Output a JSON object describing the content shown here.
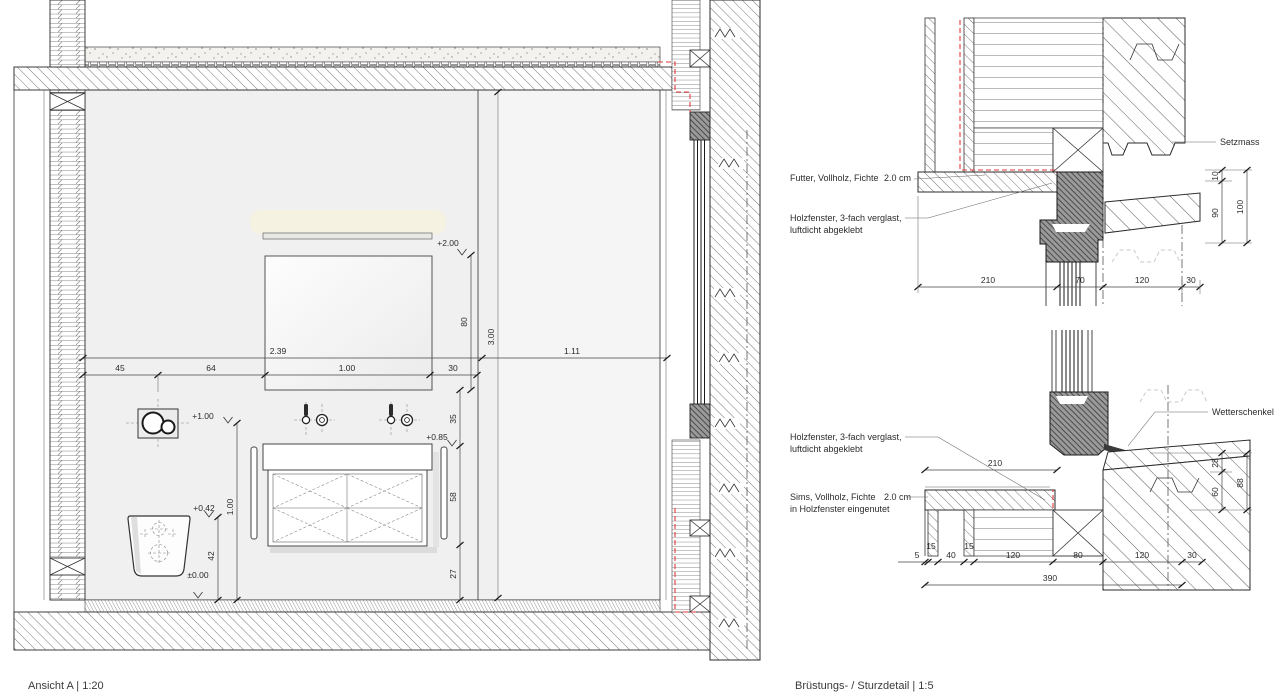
{
  "colors": {
    "airtight_tape_red": "#e03a3a",
    "room_fill": "#f0f0f0",
    "frame_gray": "#9a9a9a"
  },
  "elevation": {
    "caption": "Ansicht A | 1:20",
    "dim_239": "2.39",
    "dim_111": "1.11",
    "chain_bottom": [
      "45",
      "64",
      "1.00",
      "30"
    ],
    "dim_300": "3.00",
    "dim_80": "80",
    "chain_right": [
      "35",
      "58",
      "27"
    ],
    "dim_100": "1.00",
    "dim_42": "42",
    "lvl_200": "+2.00",
    "lvl_100": "+1.00",
    "lvl_085": "+0.85",
    "lvl_042": "+0.42",
    "lvl_000": "±0.00"
  },
  "lintel": {
    "label_futter": "Futter, Vollholz, Fichte",
    "label_futter_size": "2.0 cm",
    "label_window_1": "Holzfenster, 3-fach verglast,",
    "label_window_2": "luftdicht abgeklebt",
    "label_setzmass": "Setzmass",
    "chain_bottom": [
      "210",
      "70",
      "120",
      "30"
    ],
    "dim_10": "10",
    "dim_90": "90",
    "dim_100": "100"
  },
  "sill": {
    "caption": "Brüstungs- / Sturzdetail | 1:5",
    "label_window_1": "Holzfenster, 3-fach verglast,",
    "label_window_2": "luftdicht abgeklebt",
    "label_sims_1": "Sims, Vollholz, Fichte",
    "label_sims_size": "2.0 cm",
    "label_sims_2": "in Holzfenster eingenutet",
    "label_wetterschenkel": "Wetterschenkel",
    "dim_210": "210",
    "chain_bottom": [
      "5",
      "15",
      "40",
      "15",
      "120",
      "80",
      "120",
      "30"
    ],
    "dim_total": "390",
    "dim_28": "28",
    "dim_60": "60",
    "dim_88": "88"
  }
}
